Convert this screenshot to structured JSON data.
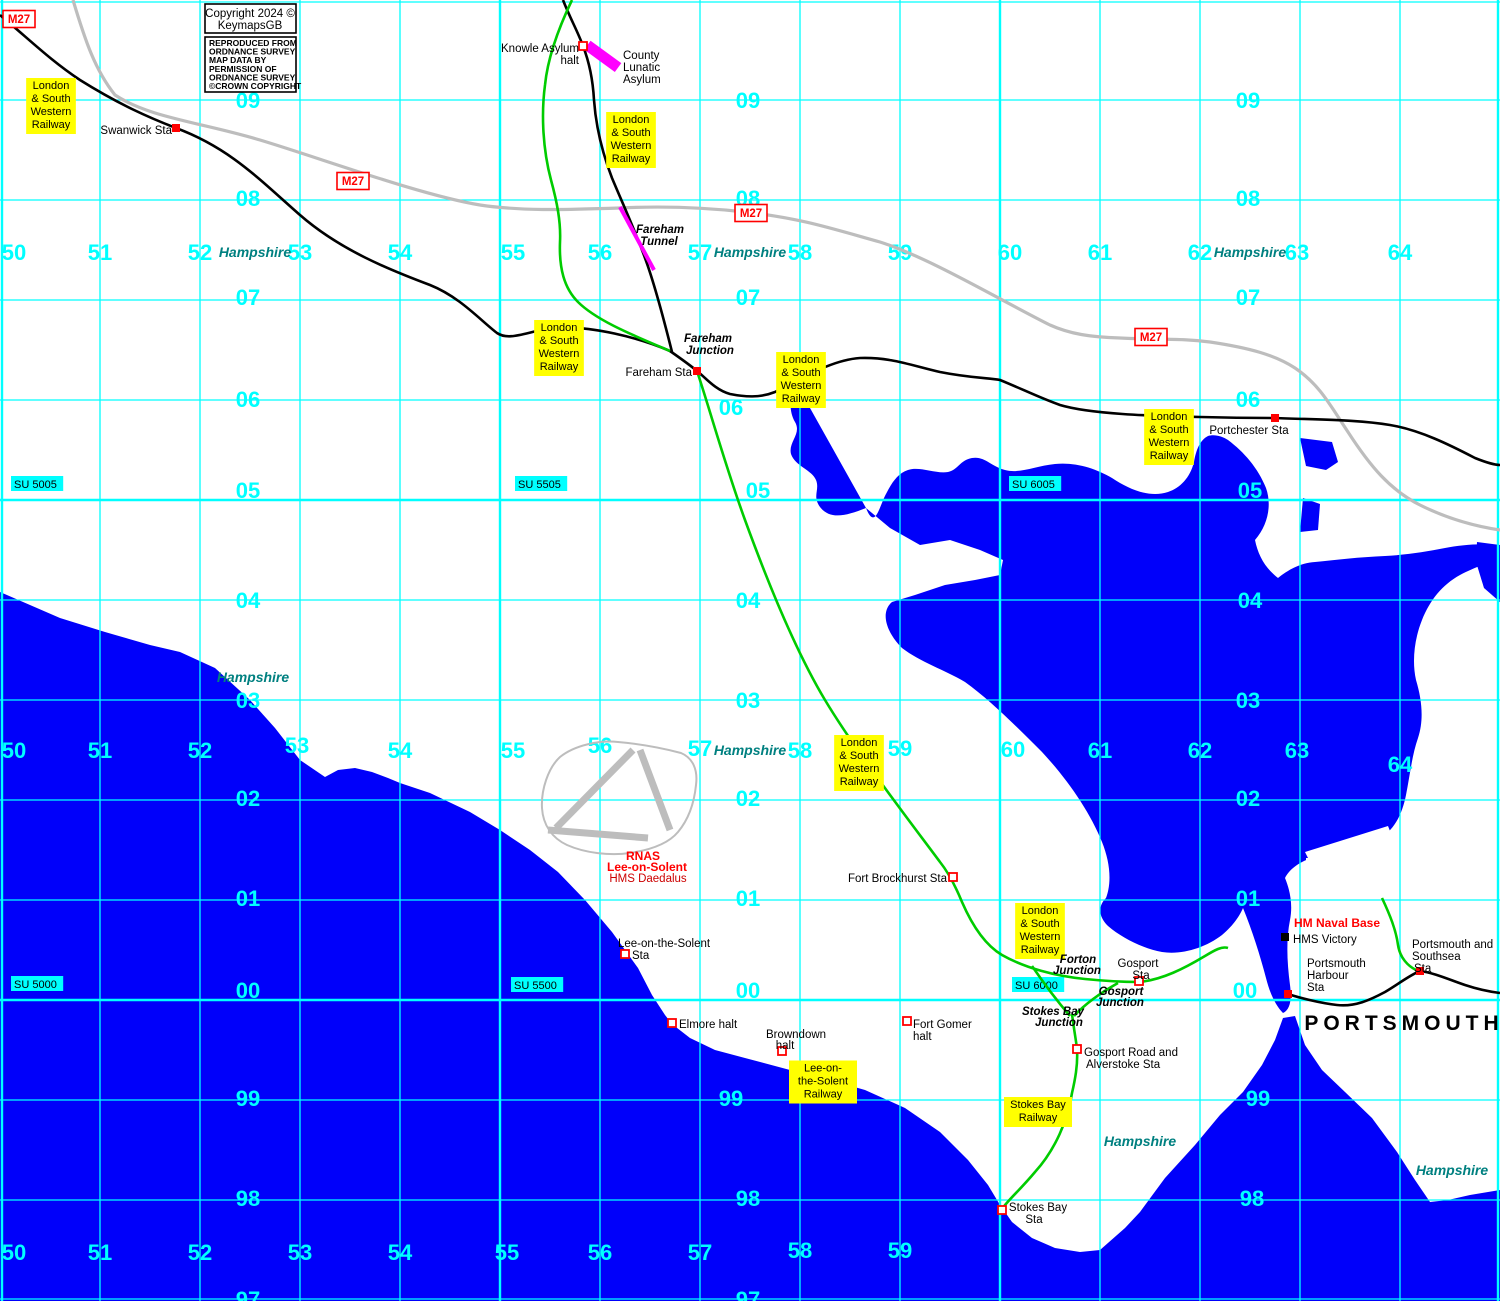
{
  "copyright": {
    "box1_lines": [
      "Copyright 2024 ©",
      "KeymapsGB"
    ],
    "box2_lines": [
      "REPRODUCED FROM",
      "ORDNANCE SURVEY",
      "MAP DATA BY",
      "PERMISSION OF",
      "ORDNANCE SURVEY",
      "©CROWN COPYRIGHT"
    ]
  },
  "colors": {
    "sea": "#0000FA",
    "grid": "#00FFFF",
    "grid_label": "#00FFFF",
    "county_text": "#008080",
    "railway_black": "#000000",
    "railway_green": "#00CC00",
    "road_grey": "#BDBDBD",
    "tunnel_magenta": "#FF00FF",
    "label_yellow": "#FFFF00",
    "station_red": "#FF0000",
    "su_bg": "#00FFFF"
  },
  "grid": {
    "column_labels": [
      {
        "text": "50",
        "x": 14,
        "y": 252
      },
      {
        "text": "51",
        "x": 100,
        "y": 252
      },
      {
        "text": "52",
        "x": 200,
        "y": 252
      },
      {
        "text": "53",
        "x": 300,
        "y": 252
      },
      {
        "text": "54",
        "x": 400,
        "y": 252
      },
      {
        "text": "55",
        "x": 513,
        "y": 252
      },
      {
        "text": "56",
        "x": 600,
        "y": 252
      },
      {
        "text": "57",
        "x": 700,
        "y": 252
      },
      {
        "text": "58",
        "x": 800,
        "y": 252
      },
      {
        "text": "59",
        "x": 900,
        "y": 252
      },
      {
        "text": "60",
        "x": 1010,
        "y": 252
      },
      {
        "text": "61",
        "x": 1100,
        "y": 252
      },
      {
        "text": "62",
        "x": 1200,
        "y": 252
      },
      {
        "text": "63",
        "x": 1297,
        "y": 252
      },
      {
        "text": "64",
        "x": 1400,
        "y": 252
      },
      {
        "text": "50",
        "x": 14,
        "y": 750
      },
      {
        "text": "51",
        "x": 100,
        "y": 750
      },
      {
        "text": "52",
        "x": 200,
        "y": 750
      },
      {
        "text": "53",
        "x": 297,
        "y": 745
      },
      {
        "text": "54",
        "x": 400,
        "y": 750
      },
      {
        "text": "55",
        "x": 513,
        "y": 750
      },
      {
        "text": "56",
        "x": 600,
        "y": 745
      },
      {
        "text": "57",
        "x": 700,
        "y": 748
      },
      {
        "text": "58",
        "x": 800,
        "y": 750
      },
      {
        "text": "59",
        "x": 900,
        "y": 748
      },
      {
        "text": "60",
        "x": 1013,
        "y": 749
      },
      {
        "text": "61",
        "x": 1100,
        "y": 750
      },
      {
        "text": "62",
        "x": 1200,
        "y": 750
      },
      {
        "text": "63",
        "x": 1297,
        "y": 750
      },
      {
        "text": "64",
        "x": 1400,
        "y": 764
      },
      {
        "text": "50",
        "x": 14,
        "y": 1252
      },
      {
        "text": "51",
        "x": 100,
        "y": 1252
      },
      {
        "text": "52",
        "x": 200,
        "y": 1252
      },
      {
        "text": "53",
        "x": 300,
        "y": 1252
      },
      {
        "text": "54",
        "x": 400,
        "y": 1252
      },
      {
        "text": "55",
        "x": 507,
        "y": 1252
      },
      {
        "text": "56",
        "x": 600,
        "y": 1252
      },
      {
        "text": "57",
        "x": 700,
        "y": 1252
      },
      {
        "text": "58",
        "x": 800,
        "y": 1250
      },
      {
        "text": "59",
        "x": 900,
        "y": 1250
      }
    ],
    "row_labels": [
      {
        "text": "09",
        "x": 248,
        "y": 100
      },
      {
        "text": "08",
        "x": 248,
        "y": 198
      },
      {
        "text": "07",
        "x": 248,
        "y": 297
      },
      {
        "text": "06",
        "x": 248,
        "y": 399
      },
      {
        "text": "05",
        "x": 248,
        "y": 490
      },
      {
        "text": "04",
        "x": 248,
        "y": 600
      },
      {
        "text": "03",
        "x": 248,
        "y": 700
      },
      {
        "text": "02",
        "x": 248,
        "y": 798
      },
      {
        "text": "01",
        "x": 248,
        "y": 898
      },
      {
        "text": "00",
        "x": 248,
        "y": 990
      },
      {
        "text": "99",
        "x": 248,
        "y": 1098
      },
      {
        "text": "98",
        "x": 248,
        "y": 1198
      },
      {
        "text": "97",
        "x": 248,
        "y": 1299
      },
      {
        "text": "09",
        "x": 748,
        "y": 100
      },
      {
        "text": "08",
        "x": 748,
        "y": 198
      },
      {
        "text": "07",
        "x": 748,
        "y": 297
      },
      {
        "text": "06",
        "x": 731,
        "y": 407
      },
      {
        "text": "05",
        "x": 758,
        "y": 490
      },
      {
        "text": "04",
        "x": 748,
        "y": 600
      },
      {
        "text": "03",
        "x": 748,
        "y": 700
      },
      {
        "text": "02",
        "x": 748,
        "y": 798
      },
      {
        "text": "01",
        "x": 748,
        "y": 898
      },
      {
        "text": "00",
        "x": 748,
        "y": 990
      },
      {
        "text": "99",
        "x": 731,
        "y": 1098
      },
      {
        "text": "98",
        "x": 748,
        "y": 1198
      },
      {
        "text": "97",
        "x": 748,
        "y": 1299
      },
      {
        "text": "09",
        "x": 1248,
        "y": 100
      },
      {
        "text": "08",
        "x": 1248,
        "y": 198
      },
      {
        "text": "07",
        "x": 1248,
        "y": 297
      },
      {
        "text": "06",
        "x": 1248,
        "y": 399
      },
      {
        "text": "05",
        "x": 1250,
        "y": 490
      },
      {
        "text": "04",
        "x": 1250,
        "y": 600
      },
      {
        "text": "03",
        "x": 1248,
        "y": 700
      },
      {
        "text": "02",
        "x": 1248,
        "y": 798
      },
      {
        "text": "01",
        "x": 1248,
        "y": 898
      },
      {
        "text": "00",
        "x": 1245,
        "y": 990
      },
      {
        "text": "99",
        "x": 1258,
        "y": 1098
      },
      {
        "text": "98",
        "x": 1252,
        "y": 1198
      }
    ],
    "su_labels": [
      {
        "text": "SU 5005",
        "x": 14,
        "y": 477
      },
      {
        "text": "SU 5505",
        "x": 518,
        "y": 477
      },
      {
        "text": "SU 6005",
        "x": 1012,
        "y": 477
      },
      {
        "text": "SU 5000",
        "x": 14,
        "y": 977
      },
      {
        "text": "SU 5500",
        "x": 514,
        "y": 978
      },
      {
        "text": "SU 6000",
        "x": 1015,
        "y": 978
      }
    ]
  },
  "motorway": {
    "name": "M27",
    "badges": [
      {
        "x": 19,
        "y": 19
      },
      {
        "x": 353,
        "y": 181
      },
      {
        "x": 751,
        "y": 213
      },
      {
        "x": 1151,
        "y": 337
      }
    ]
  },
  "railway_boxes": [
    {
      "name": "lswr-box",
      "lines": [
        "London",
        "& South",
        "Western",
        "Railway"
      ],
      "positions": [
        {
          "x": 51,
          "y": 106
        },
        {
          "x": 631,
          "y": 140
        },
        {
          "x": 559,
          "y": 348
        },
        {
          "x": 801,
          "y": 380
        },
        {
          "x": 1169,
          "y": 437
        },
        {
          "x": 859,
          "y": 763
        },
        {
          "x": 1040,
          "y": 931
        }
      ]
    },
    {
      "name": "lee-on-the-solent-railway-box",
      "lines": [
        "Lee-on-",
        "the-Solent",
        "Railway"
      ],
      "positions": [
        {
          "x": 823,
          "y": 1082
        }
      ]
    },
    {
      "name": "stokes-bay-railway-box",
      "lines": [
        "Stokes Bay",
        "Railway"
      ],
      "positions": [
        {
          "x": 1038,
          "y": 1112
        }
      ]
    }
  ],
  "stations": [
    {
      "name": "Swanwick Sta",
      "marker": "filled",
      "mx": 176,
      "my": 128,
      "labels": [
        {
          "text": "Swanwick Sta",
          "x": 172,
          "y": 130,
          "anchor": "end"
        }
      ]
    },
    {
      "name": "Knowle Asylum halt",
      "marker": "open",
      "mx": 583,
      "my": 46,
      "labels": [
        {
          "text": "Knowle Asylum",
          "x": 579,
          "y": 48,
          "anchor": "end"
        },
        {
          "text": "halt",
          "x": 579,
          "y": 60,
          "anchor": "end"
        }
      ]
    },
    {
      "name": "Fareham Sta",
      "marker": "filled",
      "mx": 697,
      "my": 371,
      "labels": [
        {
          "text": "Fareham Sta",
          "x": 692,
          "y": 372,
          "anchor": "end"
        }
      ]
    },
    {
      "name": "Portchester Sta",
      "marker": "filled",
      "mx": 1275,
      "my": 418,
      "labels": [
        {
          "text": "Portchester Sta",
          "x": 1249,
          "y": 430,
          "anchor": "middle"
        }
      ]
    },
    {
      "name": "Fort Brockhurst Sta",
      "marker": "open",
      "mx": 953,
      "my": 877,
      "labels": [
        {
          "text": "Fort Brockhurst Sta",
          "x": 947,
          "y": 878,
          "anchor": "end"
        }
      ]
    },
    {
      "name": "Lee-on-the-Solent Sta",
      "marker": "open",
      "mx": 625,
      "my": 954,
      "labels": [
        {
          "text": "Lee-on-the-Solent",
          "x": 618,
          "y": 943,
          "anchor": "start"
        },
        {
          "text": "Sta",
          "x": 632,
          "y": 955,
          "anchor": "start"
        }
      ]
    },
    {
      "name": "Elmore halt",
      "marker": "open",
      "mx": 672,
      "my": 1023,
      "labels": [
        {
          "text": "Elmore halt",
          "x": 679,
          "y": 1024,
          "anchor": "start"
        }
      ]
    },
    {
      "name": "Browndown halt",
      "marker": "open",
      "mx": 782,
      "my": 1051,
      "labels": [
        {
          "text": "Browndown",
          "x": 796,
          "y": 1034,
          "anchor": "middle"
        },
        {
          "text": "halt",
          "x": 785,
          "y": 1045,
          "anchor": "middle"
        }
      ]
    },
    {
      "name": "Fort Gomer halt",
      "marker": "open",
      "mx": 907,
      "my": 1021,
      "labels": [
        {
          "text": "Fort Gomer",
          "x": 913,
          "y": 1024,
          "anchor": "start"
        },
        {
          "text": "halt",
          "x": 913,
          "y": 1036,
          "anchor": "start"
        }
      ]
    },
    {
      "name": "Gosport Sta",
      "marker": "open",
      "mx": 1139,
      "my": 981,
      "labels": [
        {
          "text": "Gosport",
          "x": 1138,
          "y": 963,
          "anchor": "middle"
        },
        {
          "text": "Sta",
          "x": 1141,
          "y": 975,
          "anchor": "middle"
        }
      ]
    },
    {
      "name": "Gosport Road and Alverstoke Sta",
      "marker": "open",
      "mx": 1077,
      "my": 1049,
      "labels": [
        {
          "text": "Gosport Road and",
          "x": 1084,
          "y": 1052,
          "anchor": "start"
        },
        {
          "text": "Alverstoke Sta",
          "x": 1086,
          "y": 1064,
          "anchor": "start"
        }
      ]
    },
    {
      "name": "Stokes Bay Sta",
      "marker": "open",
      "mx": 1002,
      "my": 1210,
      "labels": [
        {
          "text": "Stokes Bay",
          "x": 1038,
          "y": 1207,
          "anchor": "middle"
        },
        {
          "text": "Sta",
          "x": 1034,
          "y": 1219,
          "anchor": "middle"
        }
      ]
    },
    {
      "name": "Portsmouth Harbour Sta",
      "marker": "filled",
      "mx": 1288,
      "my": 994,
      "labels": [
        {
          "text": "Portsmouth",
          "x": 1307,
          "y": 963,
          "anchor": "start"
        },
        {
          "text": "Harbour",
          "x": 1307,
          "y": 975,
          "anchor": "start"
        },
        {
          "text": "Sta",
          "x": 1307,
          "y": 987,
          "anchor": "start"
        }
      ]
    },
    {
      "name": "Portsmouth and Southsea Sta",
      "marker": "filled",
      "mx": 1420,
      "my": 971,
      "labels": [
        {
          "text": "Portsmouth and",
          "x": 1412,
          "y": 944,
          "anchor": "start"
        },
        {
          "text": "Southsea",
          "x": 1412,
          "y": 956,
          "anchor": "start"
        },
        {
          "text": "Sta",
          "x": 1414,
          "y": 968,
          "anchor": "start"
        }
      ]
    }
  ],
  "junctions": [
    {
      "name": "Fareham Junction",
      "lines": [
        {
          "text": "Fareham",
          "x": 708,
          "y": 338
        },
        {
          "text": "Junction",
          "x": 710,
          "y": 350
        }
      ]
    },
    {
      "name": "Fareham Tunnel",
      "lines": [
        {
          "text": "Fareham",
          "x": 660,
          "y": 229
        },
        {
          "text": "Tunnel",
          "x": 659,
          "y": 241
        }
      ]
    },
    {
      "name": "Forton Junction",
      "lines": [
        {
          "text": "Forton",
          "x": 1078,
          "y": 959
        },
        {
          "text": "Junction",
          "x": 1077,
          "y": 970
        }
      ]
    },
    {
      "name": "Gosport Junction",
      "lines": [
        {
          "text": "Gosport",
          "x": 1121,
          "y": 991
        },
        {
          "text": "Junction",
          "x": 1120,
          "y": 1002
        }
      ]
    },
    {
      "name": "Stokes Bay Junction",
      "lines": [
        {
          "text": "Stokes Bay",
          "x": 1053,
          "y": 1011
        },
        {
          "text": "Junction",
          "x": 1059,
          "y": 1022
        }
      ]
    }
  ],
  "places": {
    "hampshire_labels": [
      {
        "x": 255,
        "y": 253
      },
      {
        "x": 750,
        "y": 253
      },
      {
        "x": 1250,
        "y": 253
      },
      {
        "x": 253,
        "y": 678
      },
      {
        "x": 750,
        "y": 751
      },
      {
        "x": 1140,
        "y": 1142
      },
      {
        "x": 1452,
        "y": 1171
      }
    ],
    "portsmouth": {
      "text": "PORTSMOUTH",
      "x": 1404,
      "y": 1024
    },
    "hm_naval_base": {
      "text": "HM Naval Base",
      "x": 1337,
      "y": 923
    },
    "hms_victory": {
      "text": "HMS Victory",
      "x": 1293,
      "y": 939,
      "mx": 1285,
      "my": 937
    },
    "rnas": [
      {
        "text": "RNAS",
        "x": 643,
        "y": 856,
        "bold": true
      },
      {
        "text": "Lee-on-Solent",
        "x": 647,
        "y": 867,
        "bold": true
      },
      {
        "text": "HMS Daedalus",
        "x": 648,
        "y": 878,
        "bold": false
      }
    ],
    "county_lunatic_asylum": {
      "lines": [
        {
          "text": "County",
          "x": 623,
          "y": 55
        },
        {
          "text": "Lunatic",
          "x": 623,
          "y": 67
        },
        {
          "text": "Asylum",
          "x": 623,
          "y": 79
        }
      ]
    }
  }
}
